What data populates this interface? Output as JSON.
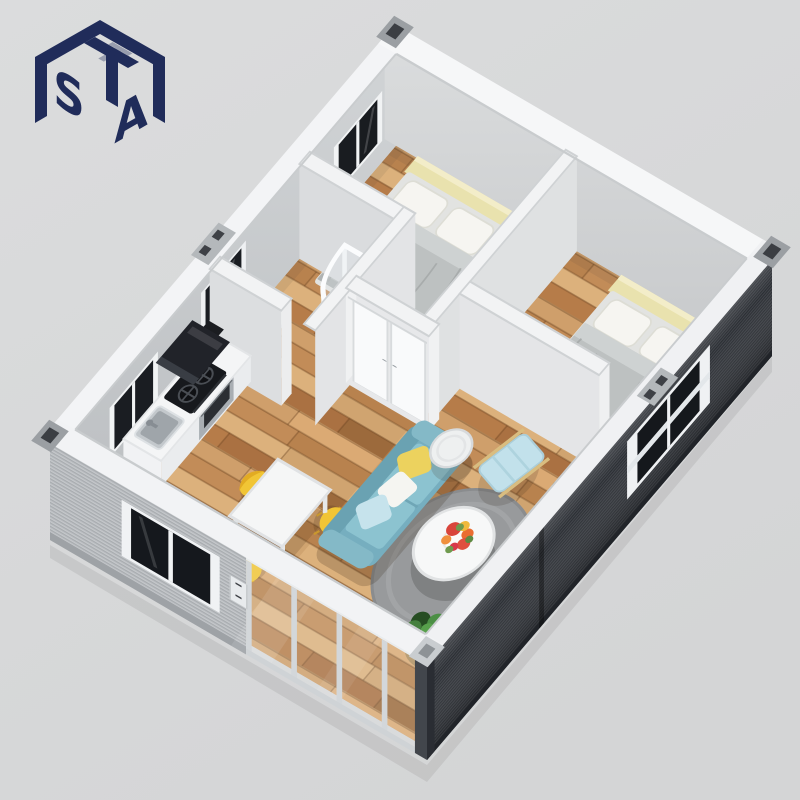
{
  "logo": {
    "letter_top": "T",
    "letter_left": "S",
    "letter_right": "A",
    "color": "#202c5a",
    "shape": "isometric cube monogram"
  },
  "scene": {
    "type": "isometric 3D cutaway render",
    "subject": "prefabricated container house interior floor plan, viewed from above",
    "background_color": "#d8d9da",
    "floor": "light oak plank flooring",
    "rooms": [
      {
        "name": "bedroom-1",
        "furniture": [
          "double bed with grey duvet",
          "two white pillows",
          "pale yellow headboard",
          "wooden nightstand",
          "table lamp",
          "dark framed wall window"
        ]
      },
      {
        "name": "bedroom-2",
        "furniture": [
          "double bed with grey duvet",
          "two white pillows",
          "pale yellow headboard"
        ]
      },
      {
        "name": "bathroom",
        "furniture": [
          "curved corner shower enclosure",
          "toilet",
          "dark wall window"
        ]
      },
      {
        "name": "kitchen",
        "furniture": [
          "white counter cabinets",
          "black cooktop with two burners",
          "black range hood",
          "stainless sink",
          "dark framed wall window"
        ]
      },
      {
        "name": "dining-area",
        "furniture": [
          "white square table",
          "three yellow chairs"
        ]
      },
      {
        "name": "living-room",
        "furniture": [
          "teal three-seat sofa",
          "yellow white and blue throw pillows",
          "grey round rug",
          "white round coffee table with flowers",
          "round side table",
          "light blue lounge chair",
          "green plants"
        ]
      }
    ],
    "exterior": {
      "left_wall": "light grey corrugated panel with dark framed window",
      "front_wall": "glass sliding doors with white frames",
      "right_wall": "dark grey corrugated panel with framed window",
      "trim": "white top rails with container corner castings"
    },
    "palette": {
      "wood_light": "#dcb17c",
      "wood_dark": "#aa7142",
      "sofa_teal": "#7fb7c6",
      "chair_yellow": "#f1c535",
      "dark_wall": "#33373d",
      "light_wall": "#b7babd",
      "white_trim": "#f3f4f6"
    }
  }
}
